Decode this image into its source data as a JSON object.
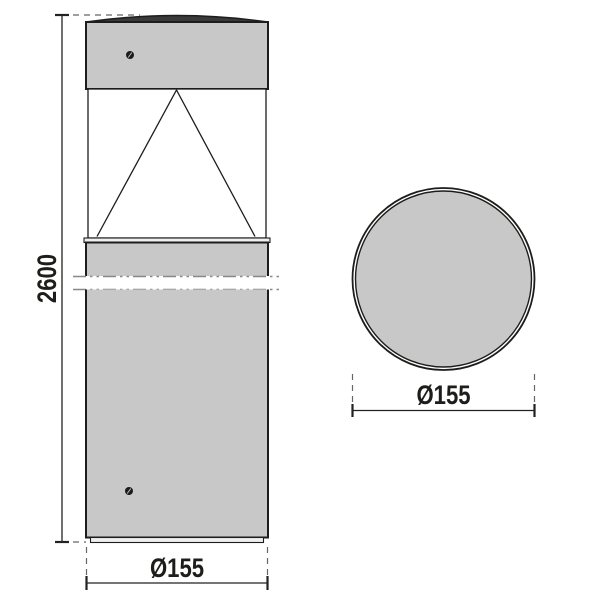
{
  "figure": {
    "type": "technical-dimension-drawing",
    "subject": "cylindrical bollard luminaire",
    "views": [
      {
        "id": "elevation",
        "name": "front elevation",
        "features": [
          "domed cap",
          "lamp head with screw",
          "clear diffuser with conical reflector",
          "collar ring",
          "post with break lines",
          "post screw",
          "base plate"
        ],
        "dimensions": [
          {
            "axis": "height",
            "label": "2600"
          },
          {
            "axis": "diameter",
            "label": "Ø155"
          }
        ]
      },
      {
        "id": "top",
        "name": "top view",
        "features": [
          "double-ring circular outline"
        ],
        "dimensions": [
          {
            "axis": "diameter",
            "label": "Ø155"
          }
        ]
      }
    ]
  },
  "labels": {
    "height": "2600",
    "elevation_diameter": "Ø155",
    "top_diameter": "Ø155"
  },
  "colors": {
    "background": "#ffffff",
    "outline": "#1d1d1b",
    "body_fill": "#c8c8c8",
    "cap_fill": "#3a3a3a",
    "plate_fill": "#efefef",
    "diffuser_fill": "#ffffff",
    "screw_fill": "#1c1c1c",
    "dim_color": "#222222",
    "dash_color": "#666666",
    "break_color": "#888888"
  }
}
